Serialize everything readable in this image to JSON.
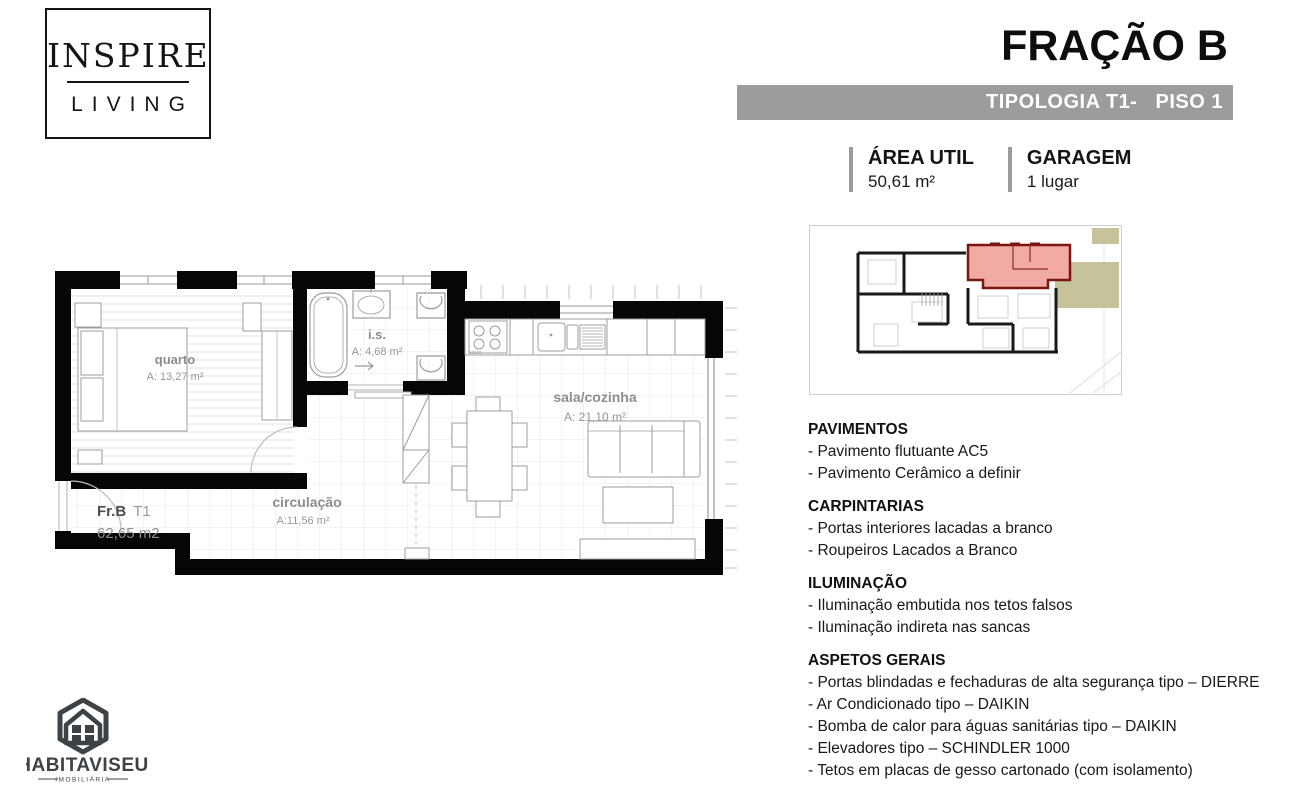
{
  "brand": {
    "line1": "INSPIRE",
    "line2": "LIVING"
  },
  "header": {
    "title": "FRAÇÃO B",
    "subtitle": "TIPOLOGIA T1-   PISO 1"
  },
  "info": {
    "area_label": "ÁREA UTIL",
    "area_value": "50,61 m²",
    "garage_label": "GARAGEM",
    "garage_value": "1 lugar"
  },
  "floorplan": {
    "unit_label": "Fr.B",
    "unit_type": "T1",
    "unit_area": "62,65 m2",
    "stove_note": "10000",
    "rooms": [
      {
        "name": "quarto",
        "area": "A: 13,27 m²"
      },
      {
        "name": "i.s.",
        "area": "A: 4,68 m²"
      },
      {
        "name": "sala/cozinha",
        "area": "A: 21,10 m²"
      },
      {
        "name": "circulação",
        "area": "A:11,56 m²"
      }
    ]
  },
  "specs": {
    "sections": [
      {
        "heading": "PAVIMENTOS",
        "items": [
          "- Pavimento flutuante AC5",
          "- Pavimento Cerâmico a definir"
        ]
      },
      {
        "heading": "CARPINTARIAS",
        "items": [
          "- Portas interiores lacadas a branco",
          "- Roupeiros Lacados a Branco"
        ]
      },
      {
        "heading": "ILUMINAÇÃO",
        "items": [
          "- Iluminação embutida nos tetos falsos",
          "- Iluminação indireta nas sancas"
        ]
      },
      {
        "heading": "ASPETOS GERAIS",
        "items": [
          "- Portas blindadas e fechaduras de alta segurança tipo – DIERRE",
          "- Ar Condicionado tipo – DAIKIN",
          "- Bomba de calor para águas sanitárias tipo – DAIKIN",
          "- Elevadores tipo – SCHINDLER 1000",
          "- Tetos em placas de gesso cartonado (com isolamento)"
        ]
      }
    ]
  },
  "footer_logo": {
    "name": "HABITAVISEU",
    "tagline": "IMOBILIÁRIA"
  },
  "colors": {
    "accent_bar": "#9c9c9c",
    "highlight_fill": "#f1aaa4",
    "highlight_stroke": "#7a150f",
    "khaki": "#c6c299"
  }
}
